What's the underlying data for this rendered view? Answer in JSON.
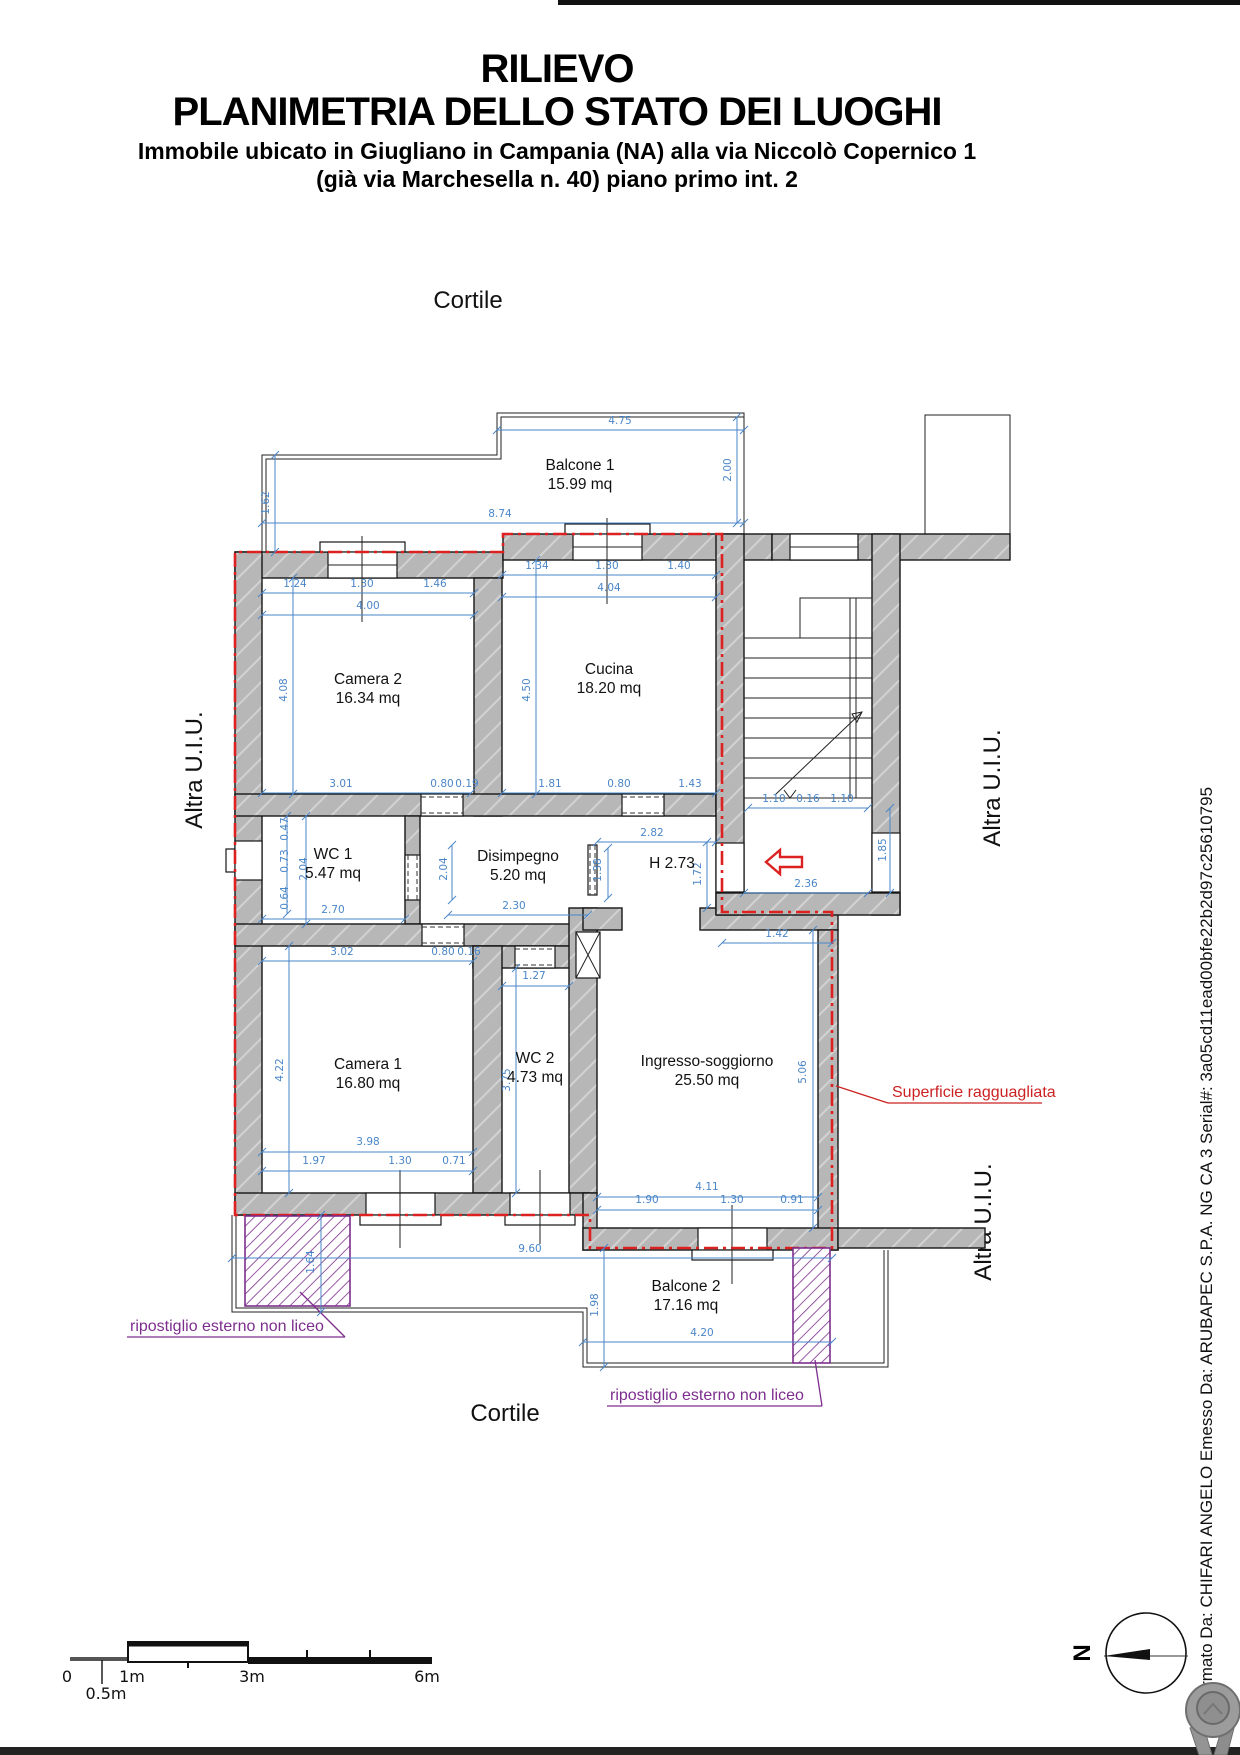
{
  "header": {
    "title1": "RILIEVO",
    "title2": "PLANIMETRIA DELLO STATO DEI LUOGHI",
    "subtitle1": "Immobile ubicato in Giugliano in Campania (NA) alla via Niccolò Copernico 1",
    "subtitle2": "(già via Marchesella n. 40) piano primo int. 2"
  },
  "context": {
    "cortile": "Cortile",
    "altra_uiu": "Altra U.I.U."
  },
  "rooms": [
    {
      "name": "Balcone 1",
      "area": "15.99 mq",
      "x": 580,
      "y": 470
    },
    {
      "name": "Camera 2",
      "area": "16.34 mq",
      "x": 368,
      "y": 684
    },
    {
      "name": "Cucina",
      "area": "18.20 mq",
      "x": 609,
      "y": 674
    },
    {
      "name": "WC 1",
      "area": "5.47 mq",
      "x": 333,
      "y": 859
    },
    {
      "name": "Disimpegno",
      "area": "5.20 mq",
      "x": 518,
      "y": 861
    },
    {
      "name": "H 2.73",
      "area": "",
      "x": 672,
      "y": 868
    },
    {
      "name": "Camera 1",
      "area": "16.80 mq",
      "x": 368,
      "y": 1069
    },
    {
      "name": "WC 2",
      "area": "4.73 mq",
      "x": 535,
      "y": 1063
    },
    {
      "name": "Ingresso-soggiorno",
      "area": "25.50 mq",
      "x": 707,
      "y": 1066
    },
    {
      "name": "Balcone 2",
      "area": "17.16 mq",
      "x": 686,
      "y": 1291
    }
  ],
  "dimensions": [
    {
      "t": "4.75",
      "x": 620,
      "y": 424
    },
    {
      "t": "2.00",
      "x": 731,
      "y": 470,
      "r": -90
    },
    {
      "t": "8.74",
      "x": 500,
      "y": 517
    },
    {
      "t": "1.62",
      "x": 269,
      "y": 503,
      "r": -90
    },
    {
      "t": "1.24",
      "x": 295,
      "y": 587
    },
    {
      "t": "1.30",
      "x": 362,
      "y": 587
    },
    {
      "t": "1.46",
      "x": 435,
      "y": 587
    },
    {
      "t": "4.00",
      "x": 368,
      "y": 609
    },
    {
      "t": "4.08",
      "x": 287,
      "y": 690,
      "r": -90
    },
    {
      "t": "1.34",
      "x": 537,
      "y": 569
    },
    {
      "t": "1.30",
      "x": 607,
      "y": 569
    },
    {
      "t": "1.40",
      "x": 679,
      "y": 569
    },
    {
      "t": "4.04",
      "x": 609,
      "y": 591
    },
    {
      "t": "4.50",
      "x": 530,
      "y": 690,
      "r": -90
    },
    {
      "t": "3.01",
      "x": 341,
      "y": 787
    },
    {
      "t": "0.80",
      "x": 442,
      "y": 787
    },
    {
      "t": "0.19",
      "x": 467,
      "y": 787
    },
    {
      "t": "1.81",
      "x": 550,
      "y": 787
    },
    {
      "t": "0.80",
      "x": 619,
      "y": 787
    },
    {
      "t": "1.43",
      "x": 690,
      "y": 787
    },
    {
      "t": "2.82",
      "x": 652,
      "y": 836
    },
    {
      "t": "1.38",
      "x": 601,
      "y": 870,
      "r": -90
    },
    {
      "t": "1.72",
      "x": 701,
      "y": 874,
      "r": -90
    },
    {
      "t": "0.47",
      "x": 288,
      "y": 829,
      "r": -90
    },
    {
      "t": "0.73",
      "x": 288,
      "y": 861,
      "r": -90
    },
    {
      "t": "2.04",
      "x": 307,
      "y": 869,
      "r": -90
    },
    {
      "t": "0.64",
      "x": 288,
      "y": 898,
      "r": -90
    },
    {
      "t": "2.70",
      "x": 333,
      "y": 913
    },
    {
      "t": "2.04",
      "x": 447,
      "y": 869,
      "r": -90
    },
    {
      "t": "2.30",
      "x": 514,
      "y": 909
    },
    {
      "t": "3.02",
      "x": 342,
      "y": 955
    },
    {
      "t": "0.80",
      "x": 443,
      "y": 955
    },
    {
      "t": "0.16",
      "x": 469,
      "y": 955
    },
    {
      "t": "1.27",
      "x": 534,
      "y": 979
    },
    {
      "t": "3.75",
      "x": 510,
      "y": 1080,
      "r": -90
    },
    {
      "t": "4.22",
      "x": 283,
      "y": 1070,
      "r": -90
    },
    {
      "t": "3.98",
      "x": 368,
      "y": 1145
    },
    {
      "t": "1.97",
      "x": 314,
      "y": 1164
    },
    {
      "t": "1.30",
      "x": 400,
      "y": 1164
    },
    {
      "t": "0.71",
      "x": 454,
      "y": 1164
    },
    {
      "t": "5.06",
      "x": 806,
      "y": 1072,
      "r": -90
    },
    {
      "t": "4.11",
      "x": 707,
      "y": 1190
    },
    {
      "t": "1.90",
      "x": 647,
      "y": 1203
    },
    {
      "t": "1.30",
      "x": 732,
      "y": 1203
    },
    {
      "t": "0.91",
      "x": 792,
      "y": 1203
    },
    {
      "t": "1.42",
      "x": 777,
      "y": 937
    },
    {
      "t": "1.10",
      "x": 774,
      "y": 802
    },
    {
      "t": "0.16",
      "x": 808,
      "y": 802
    },
    {
      "t": "1.10",
      "x": 842,
      "y": 802
    },
    {
      "t": "1.85",
      "x": 886,
      "y": 850,
      "r": -90
    },
    {
      "t": "2.36",
      "x": 806,
      "y": 887
    },
    {
      "t": "9.60",
      "x": 530,
      "y": 1252
    },
    {
      "t": "1.64",
      "x": 314,
      "y": 1262,
      "r": -90
    },
    {
      "t": "1.98",
      "x": 598,
      "y": 1305,
      "r": -90
    },
    {
      "t": "4.20",
      "x": 702,
      "y": 1336
    }
  ],
  "annotations": {
    "superficie": "Superficie ragguagliata",
    "ripostiglio": "ripostiglio esterno non liceo"
  },
  "scale_bar": {
    "zero": "0",
    "half": "0.5m",
    "one": "1m",
    "three": "3m",
    "six": "6m"
  },
  "compass": {
    "north": "N"
  },
  "signature": "Firmato Da: CHIFARI ANGELO Emesso Da: ARUBAPEC S.P.A. NG CA 3 Serial#: 3a05cd11ead00bfe22b2d97c25610795",
  "colors": {
    "dimension_blue": "#4a86c8",
    "boundary_red": "#dd2020",
    "annotation_purple": "#7d2e8d",
    "wall_gray": "#b7b7b7"
  }
}
